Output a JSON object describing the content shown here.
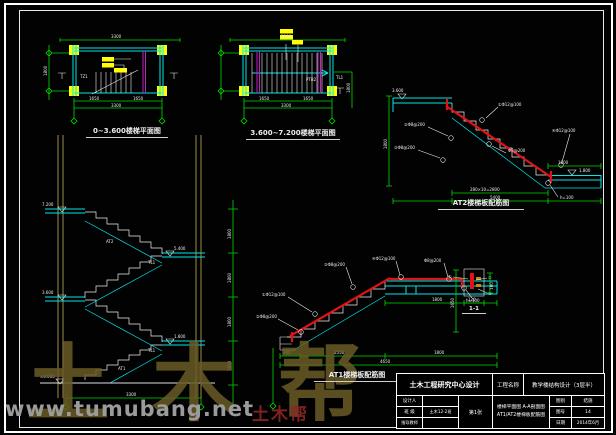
{
  "sheet": {
    "background": "#020202",
    "frame_color": "#ffffff"
  },
  "colors": {
    "cyan": "#00e8e8",
    "green": "#00d900",
    "yellow": "#ffff00",
    "magenta": "#c322c3",
    "red": "#e01414",
    "olive": "#9a8f4a",
    "watermark": "#6a5b26",
    "url_gray": "#9b9b9b"
  },
  "watermark": {
    "brand": "土木帮",
    "url": "www.tumubang.net",
    "stamp": "土木帮"
  },
  "plan1": {
    "title": "0~3.600楼梯平面图",
    "member_label": "TZ1",
    "dim_top": "3300",
    "dim_b1a": "1650",
    "dim_b1b": "1650",
    "dim_b2": "3300",
    "dim_left": "1800"
  },
  "plan2": {
    "title": "3.600~7.200楼梯平面图",
    "member_label_1": "PTB2",
    "member_label_2": "TL1",
    "dim_top": "3300",
    "dim_b1a": "1650",
    "dim_b1b": "1650",
    "dim_b2": "3300",
    "dim_right": "1800"
  },
  "section": {
    "levels": [
      "7.200",
      "5.400",
      "3.600",
      "1.800",
      "±0.000"
    ],
    "floor_dims": [
      "1800",
      "1800",
      "1800",
      "1800"
    ],
    "bottom_dim": "3300",
    "beam_label_1": "TL1",
    "beam_label_2": "TL1",
    "flight_label_upper": "AT2",
    "flight_label_lower": "AT1"
  },
  "at2": {
    "title": "AT2楼梯板配筋图",
    "level_top": "3.600",
    "level_bottom": "1.800",
    "leaders": [
      "①Φ12@100",
      "②Φ8@200",
      "③Φ8@200",
      "Φ8@200",
      "④Φ12@100",
      "h=100"
    ],
    "dim_height": "1800",
    "dim_landing": "1800",
    "dim_flight": "280×10=2800",
    "dim_total": "5400"
  },
  "at1": {
    "title": "AT1楼梯板配筋图",
    "leaders": [
      "①Φ12@100",
      "②Φ8@200",
      "③Φ8@200",
      "④Φ12@100",
      "Φ8@200",
      "h=100"
    ],
    "dim_landing": "1800",
    "dims_bottom": [
      "300",
      "2550",
      "1800"
    ],
    "dim_total": "4650"
  },
  "detail11": {
    "title": "1-1",
    "leaders": [
      "①",
      "②",
      "③"
    ],
    "dim_width": "120",
    "dim_height": "100",
    "dim_side": "1650"
  },
  "titleblock": {
    "institute": "土木工程研究中心设计",
    "project_label": "工程名称",
    "project_name": "教学楼结构设计（3层半）",
    "row1_label": "设计人",
    "row1_value": "",
    "row2_label": "班 级",
    "row2_value": "土木12-2班",
    "row3_label": "指导教师",
    "row3_value": "",
    "sheet_no": "第1张",
    "drawing_title_line1": "楼梯平面图 A-A剖面图",
    "drawing_title_line2": "AT1/AT2楼梯板配筋图",
    "meta1_label": "图别",
    "meta1_value": "结施",
    "meta2_label": "图号",
    "meta2_value": "14",
    "meta3_label": "日期",
    "meta3_value": "2014年6月"
  }
}
